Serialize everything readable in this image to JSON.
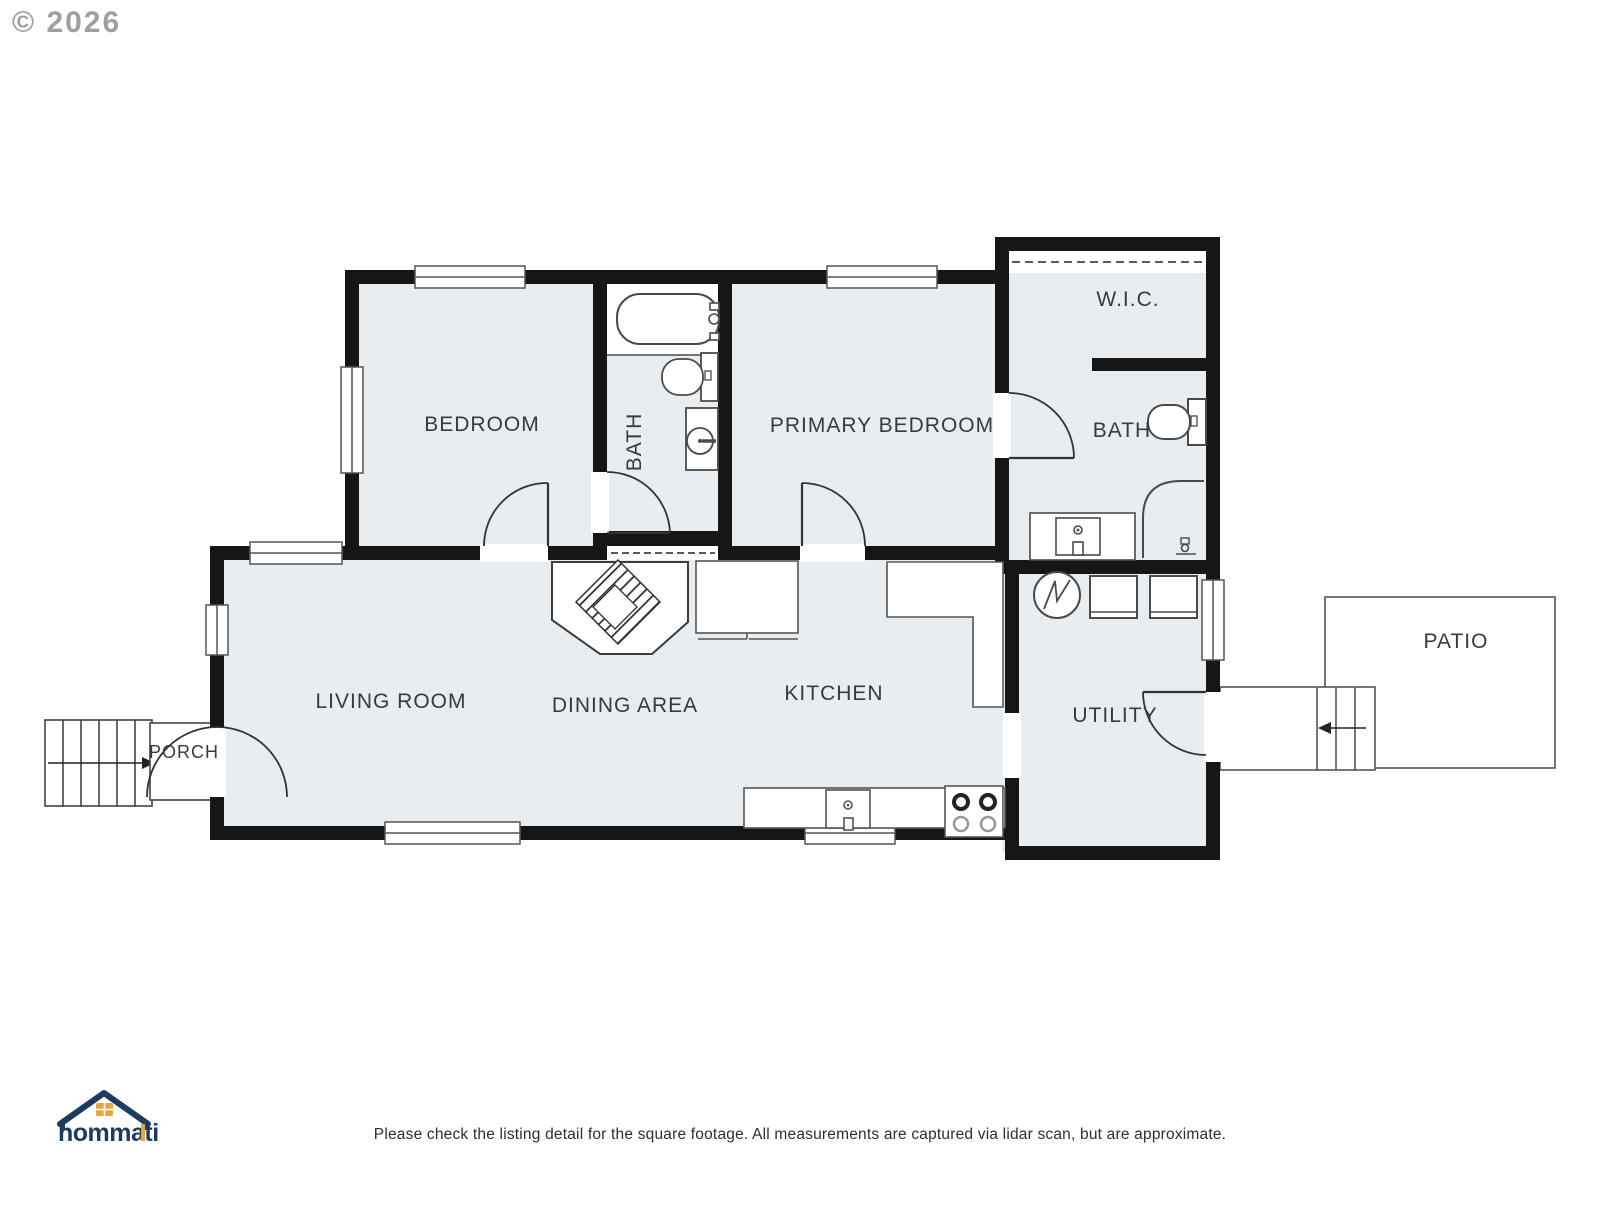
{
  "watermark": {
    "copyright": "© 2026"
  },
  "rooms": [
    {
      "id": "bedroom",
      "label": "BEDROOM"
    },
    {
      "id": "hall-bath",
      "label": "BATH"
    },
    {
      "id": "primary-bedroom",
      "label": "PRIMARY BEDROOM"
    },
    {
      "id": "wic",
      "label": "W.I.C."
    },
    {
      "id": "primary-bath",
      "label": "BATH"
    },
    {
      "id": "living-room",
      "label": "LIVING ROOM"
    },
    {
      "id": "dining-area",
      "label": "DINING AREA"
    },
    {
      "id": "kitchen",
      "label": "KITCHEN"
    },
    {
      "id": "utility",
      "label": "UTILITY"
    },
    {
      "id": "porch",
      "label": "PORCH"
    },
    {
      "id": "patio",
      "label": "PATIO"
    }
  ],
  "branding": {
    "logo_text": "hommati"
  },
  "footer": {
    "disclaimer": "Please check the listing detail for the square footage. All measurements are captured via lidar scan, but are approximate."
  },
  "colors": {
    "wall": "#161616",
    "room_fill": "#e8edf2",
    "fixture_line": "#4a4a4a",
    "logo_navy": "#1d3b5e",
    "logo_orange": "#e8a33d",
    "label_text": "#3a3a3a"
  }
}
